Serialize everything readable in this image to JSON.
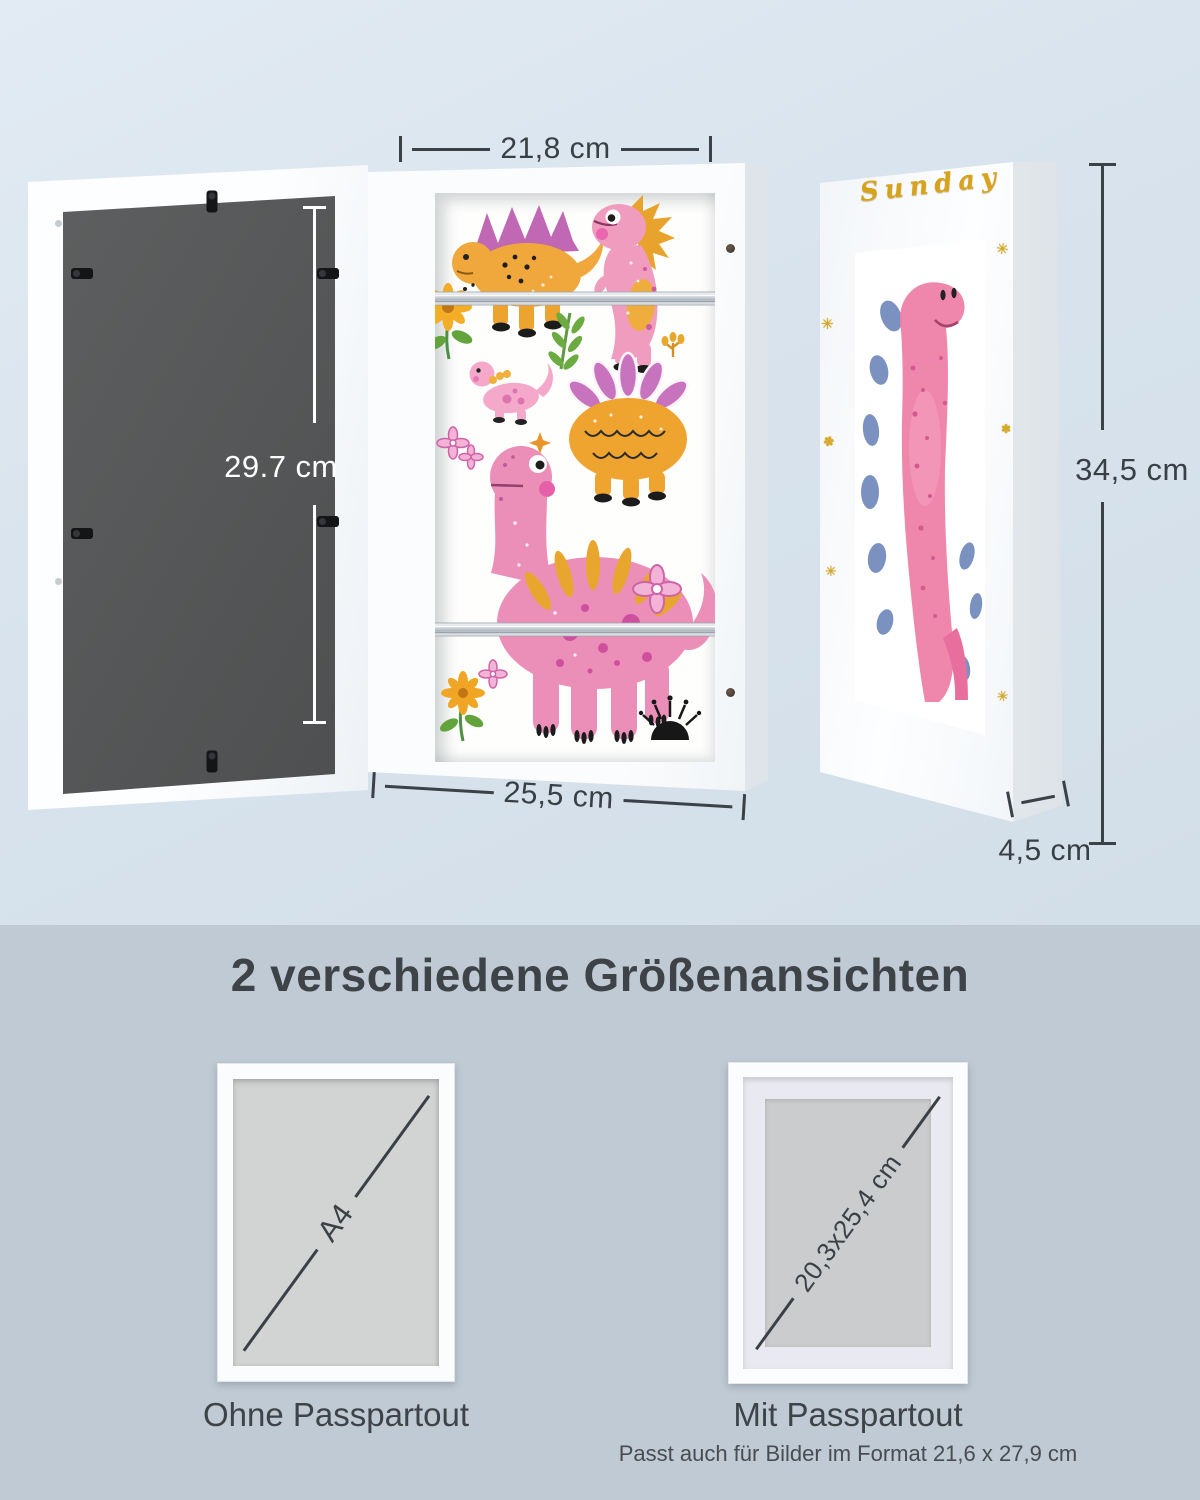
{
  "colors": {
    "background_top": "#d8e3ed",
    "background_bottom": "#bfcad4",
    "dimension_line": "#3a4147",
    "gold_decor": "#d7a31d",
    "back_panel": "#57595b",
    "frame_white": "#fafbfc"
  },
  "product_views": {
    "back_height": "29.7 cm",
    "front_door_width": "21,8 cm",
    "front_outer_width": "25,5 cm",
    "side_height": "34,5 cm",
    "side_depth": "4,5 cm",
    "side_frame_decor_text": "Sunday"
  },
  "size_section": {
    "title": "2 verschiedene Größenansichten",
    "variants": [
      {
        "size_label": "A4",
        "caption": "Ohne Passpartout"
      },
      {
        "size_label": "20,3x25,4 cm",
        "caption": "Mit Passpartout",
        "note": "Passt auch für Bilder im Format 21,6 x 27,9 cm"
      }
    ]
  }
}
